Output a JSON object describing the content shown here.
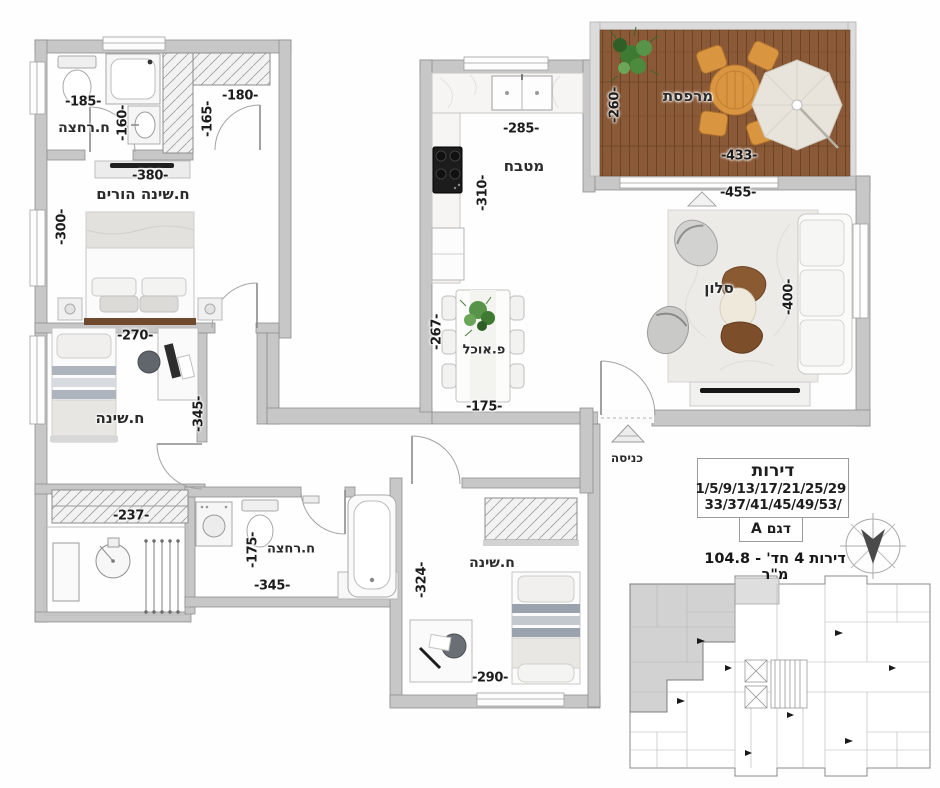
{
  "info": {
    "apartments_title": "דירות",
    "apartments_line1": "1/5/9/13/17/21/25/29",
    "apartments_line2": "/33/37/41/45/49/53",
    "model": "דגם A",
    "area": "דירות 4 חד' - 104.8 מ\"ר"
  },
  "rooms": [
    {
      "id": "bath1",
      "label": "ח.רחצה",
      "x": 84,
      "y": 128,
      "size": 14
    },
    {
      "id": "master-bedroom",
      "label": "ח.שינה הורים",
      "x": 143,
      "y": 194,
      "size": 15
    },
    {
      "id": "bedroom2",
      "label": "ח.שינה",
      "x": 120,
      "y": 418,
      "size": 15
    },
    {
      "id": "kitchen",
      "label": "מטבח",
      "x": 524,
      "y": 166,
      "size": 15
    },
    {
      "id": "dining",
      "label": "פ.אוכל",
      "x": 484,
      "y": 350,
      "size": 13
    },
    {
      "id": "living",
      "label": "סלון",
      "x": 719,
      "y": 288,
      "size": 15
    },
    {
      "id": "balcony",
      "label": "מרפסת",
      "x": 688,
      "y": 96,
      "size": 15
    },
    {
      "id": "entrance",
      "label": "כניסה",
      "x": 627,
      "y": 458,
      "size": 12
    },
    {
      "id": "bath2",
      "label": "ח.רחצה",
      "x": 291,
      "y": 549,
      "size": 13
    },
    {
      "id": "bedroom3",
      "label": "ח.שינה",
      "x": 492,
      "y": 563,
      "size": 14
    }
  ],
  "dimensions": [
    {
      "text": "-185-",
      "x": 83,
      "y": 102,
      "rot": 0
    },
    {
      "text": "-160-",
      "x": 123,
      "y": 123,
      "rot": -90
    },
    {
      "text": "-180-",
      "x": 240,
      "y": 96,
      "rot": 0
    },
    {
      "text": "-165-",
      "x": 208,
      "y": 119,
      "rot": -90
    },
    {
      "text": "-380-",
      "x": 150,
      "y": 176,
      "rot": 0
    },
    {
      "text": "-300-",
      "x": 62,
      "y": 227,
      "rot": -90
    },
    {
      "text": "-270-",
      "x": 135,
      "y": 336,
      "rot": 0
    },
    {
      "text": "-345-",
      "x": 199,
      "y": 414,
      "rot": -90
    },
    {
      "text": "-237-",
      "x": 131,
      "y": 516,
      "rot": 0
    },
    {
      "text": "-175-",
      "x": 253,
      "y": 550,
      "rot": -90
    },
    {
      "text": "-345-",
      "x": 272,
      "y": 586,
      "rot": 0
    },
    {
      "text": "-324-",
      "x": 422,
      "y": 580,
      "rot": -90
    },
    {
      "text": "-290-",
      "x": 490,
      "y": 678,
      "rot": 0
    },
    {
      "text": "-285-",
      "x": 521,
      "y": 129,
      "rot": 0
    },
    {
      "text": "-310-",
      "x": 483,
      "y": 193,
      "rot": -90
    },
    {
      "text": "-267-",
      "x": 437,
      "y": 332,
      "rot": -90
    },
    {
      "text": "-175-",
      "x": 484,
      "y": 407,
      "rot": 0
    },
    {
      "text": "-260-",
      "x": 615,
      "y": 105,
      "rot": -90
    },
    {
      "text": "-433-",
      "x": 739,
      "y": 156,
      "rot": 0
    },
    {
      "text": "-455-",
      "x": 738,
      "y": 193,
      "rot": 0
    },
    {
      "text": "-400-",
      "x": 789,
      "y": 297,
      "rot": -90
    }
  ],
  "colors": {
    "wall": "#c7c7c7",
    "wall_stroke": "#8f8f8f",
    "deck": "#8a5a38",
    "garden_table": "#d9953f",
    "text": "#2b2b2b",
    "highlight_unit": "#cdcdcd"
  }
}
